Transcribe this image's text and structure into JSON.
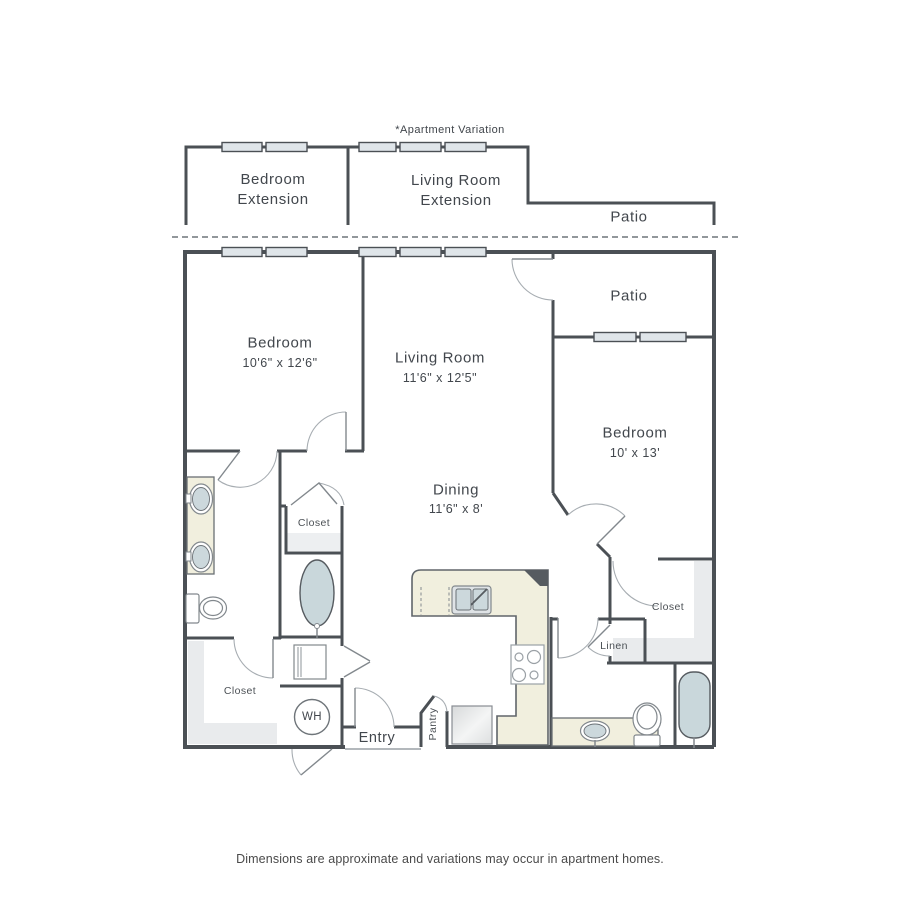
{
  "header_note": "*Apartment Variation",
  "variation": {
    "bedroom_extension": "Bedroom Extension",
    "living_room_extension": "Living Room Extension",
    "patio_label": "Patio"
  },
  "main": {
    "patio_label": "Patio",
    "bedroom1": {
      "name": "Bedroom",
      "dims": "10'6\" x 12'6\""
    },
    "living_room": {
      "name": "Living Room",
      "dims": "11'6\" x 12'5\""
    },
    "bedroom2": {
      "name": "Bedroom",
      "dims": "10' x 13'"
    },
    "dining": {
      "name": "Dining",
      "dims": "11'6\" x 8'"
    },
    "hall_closet_label": "Closet",
    "walkin_closet_label": "Closet",
    "bedroom2_closet_label": "Closet",
    "linen_label": "Linen",
    "water_heater_label": "WH",
    "entry_label": "Entry",
    "pantry_label": "Pantry"
  },
  "footer_note": "Dimensions are approximate and variations may occur in apartment homes.",
  "colors": {
    "wall": "#4b5055",
    "window_fill": "#dfe5e9",
    "counter_fill": "#f1efde",
    "water_fill": "#c9d7db",
    "shade_fill": "#e9ebed",
    "corner_dark": "#565b60"
  }
}
